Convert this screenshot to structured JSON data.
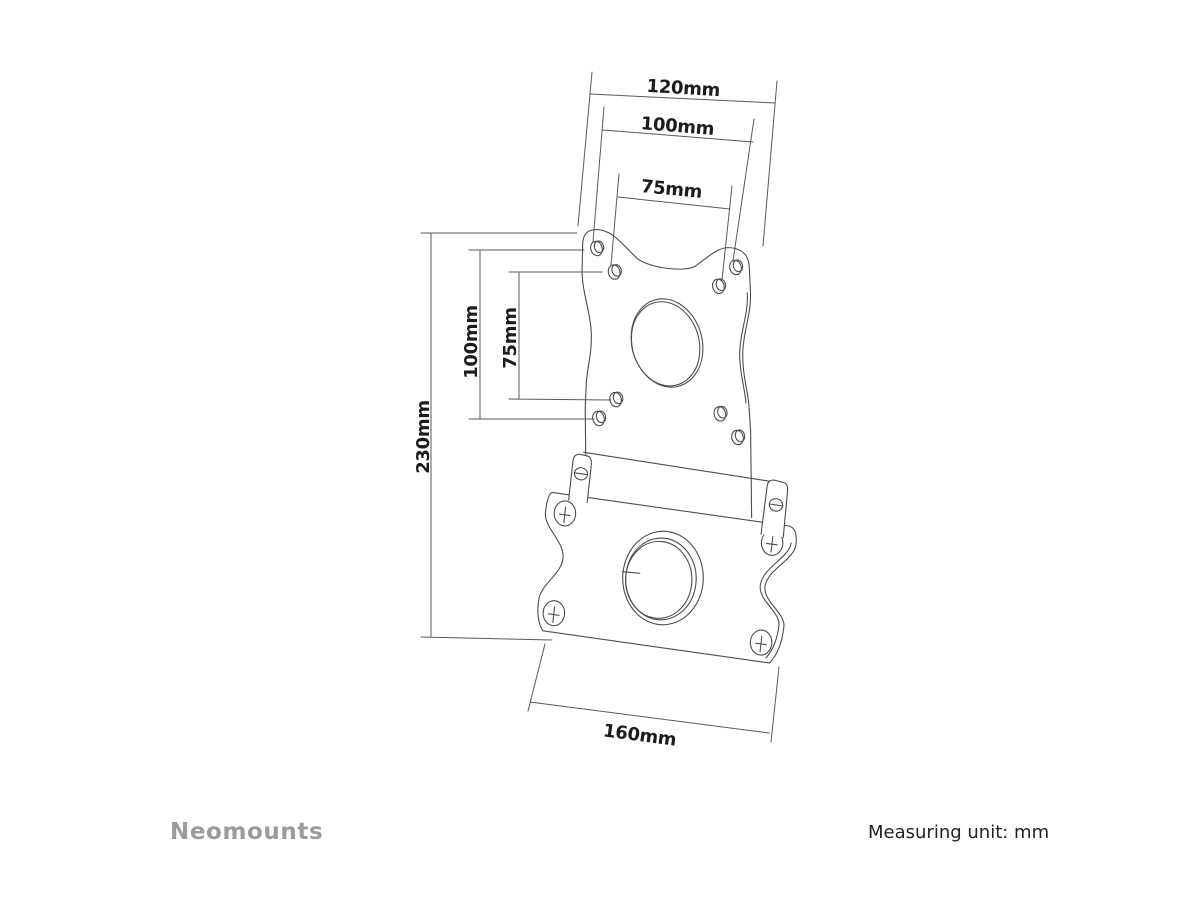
{
  "page": {
    "background": "#ffffff"
  },
  "drawing": {
    "dimension_labels": {
      "top_120": "120mm",
      "top_100": "100mm",
      "top_75": "75mm",
      "left_230": "230mm",
      "left_100": "100mm",
      "left_75": "75mm",
      "bottom_160": "160mm"
    },
    "colors": {
      "plate_line": "#4d4d4d",
      "dim_line": "#5a5a5a",
      "dim_text": "#1c1c1c",
      "brand_text": "#9b9b9b",
      "footer_text": "#222222"
    }
  },
  "footer": {
    "brand": "Neomounts",
    "measuring_unit": "Measuring unit: mm"
  }
}
